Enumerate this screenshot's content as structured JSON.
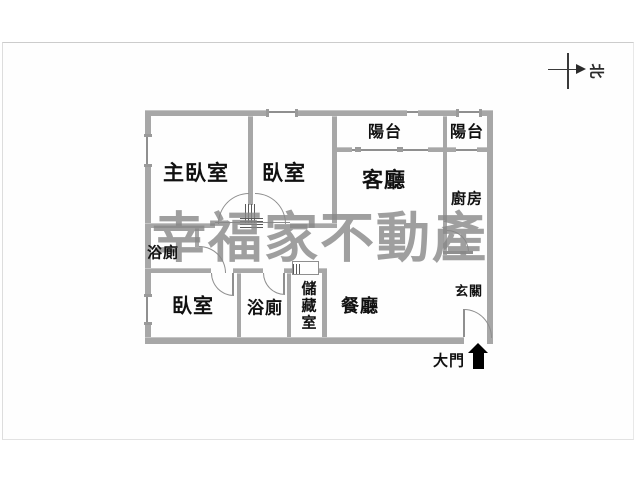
{
  "watermark": {
    "text": "幸福家不動產"
  },
  "compass": {
    "label": "北"
  },
  "floorplan": {
    "rooms": {
      "master_bedroom": {
        "label": "主臥室"
      },
      "bedroom2": {
        "label": "臥室"
      },
      "living_room": {
        "label": "客廳"
      },
      "balcony1": {
        "label": "陽台"
      },
      "balcony2": {
        "label": "陽台"
      },
      "kitchen": {
        "label": "廚房"
      },
      "bathroom1": {
        "label": "浴廁"
      },
      "bedroom3": {
        "label": "臥室"
      },
      "bathroom2": {
        "label": "浴廁"
      },
      "storage": {
        "label": "儲藏室"
      },
      "dining_room": {
        "label": "餐廳"
      },
      "foyer": {
        "label": "玄關"
      }
    },
    "entrance": {
      "label": "大門"
    }
  },
  "colors": {
    "wall": "#a7a7a7",
    "line": "#8f8f8f",
    "text": "#111111",
    "watermark": "#878787",
    "frame_border": "#cccccc",
    "entrance_arrow": "#000000"
  }
}
